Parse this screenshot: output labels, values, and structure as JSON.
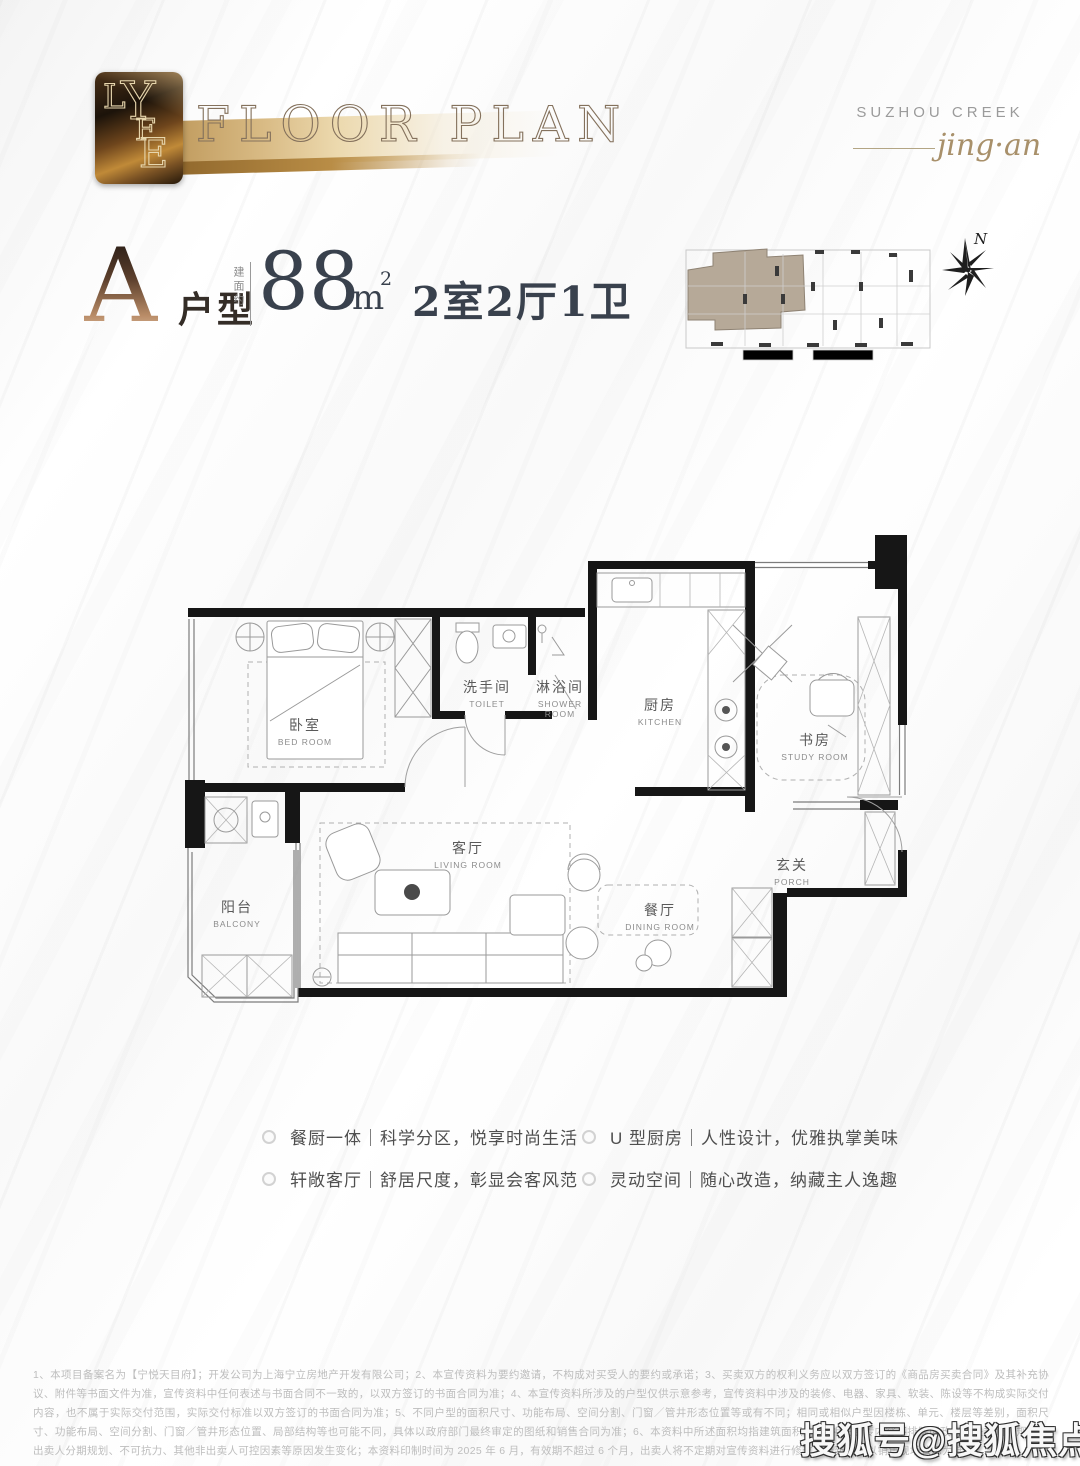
{
  "header": {
    "logo_letters": [
      "L",
      "Y",
      "F",
      "E"
    ],
    "title": "FLOOR PLAN",
    "brand_line1": "SUZHOU CREEK",
    "brand_line2": "jing·an"
  },
  "unit": {
    "letter": "A",
    "type_label": "户型",
    "area_prefix": "建面约",
    "area_value": "88",
    "area_unit": "m",
    "area_sup": "2",
    "layout": "2室2厅1卫"
  },
  "keyplan": {
    "north_label": "N",
    "highlight_color": "#b6a998"
  },
  "rooms": [
    {
      "cn": "卧室",
      "en": "BED ROOM"
    },
    {
      "cn": "洗手间",
      "en": "TOILET"
    },
    {
      "cn": "淋浴间",
      "en": "SHOWER ROOM"
    },
    {
      "cn": "厨房",
      "en": "KITCHEN"
    },
    {
      "cn": "书房",
      "en": "STUDY ROOM"
    },
    {
      "cn": "阳台",
      "en": "BALCONY"
    },
    {
      "cn": "客厅",
      "en": "LIVING ROOM"
    },
    {
      "cn": "餐厅",
      "en": "DINING ROOM"
    },
    {
      "cn": "玄关",
      "en": "PORCH"
    }
  ],
  "features": [
    "餐厨一体｜科学分区，悦享时尚生活",
    "U 型厨房｜人性设计，优雅执掌美味",
    "轩敞客厅｜舒居尺度，彰显会客风范",
    "灵动空间｜随心改造，纳藏主人逸趣"
  ],
  "disclaimer": "1、本项目备案名为【宁悦天目府】；开发公司为上海宁立房地产开发有限公司；2、本宣传资料为要约邀请，不构成对买受人的要约或承诺；3、买卖双方的权利义务应以双方签订的《商品房买卖合同》及其补充协议、附件等书面文件为准，宣传资料中任何表述与书面合同不一致的，以双方签订的书面合同为准；4、本宣传资料所涉及的户型仅供示意参考，宣传资料中涉及的装修、电器、家具、软装、陈设等不构成实际交付内容，也不属于实际交付范围，实际交付标准以双方签订的书面合同为准；5、不同户型的面积尺寸、功能布局、空间分割、门窗／管井形态位置等或有不同；相同或相似户型因楼栋、单元、楼层等差别，面积尺寸、功能布局、空间分割、门窗／管井形态位置、局部结构等也可能不同，具体以政府部门最终审定的图纸和销售合同为准；6、本资料中所述面积均指建筑面积；7、相关宣传内容不排除因政府相关规划、规定及出卖人分期规划、不可抗力、其他非出卖人可控因素等原因发生变化；本资料印制时间为 2025 年 6 月，有效期不超过 6 个月，出卖人将不定期对宣传资料进行修改，最新版本以销售现场公示为准。",
  "watermark": "搜狐号@搜狐焦点淮南站"
}
